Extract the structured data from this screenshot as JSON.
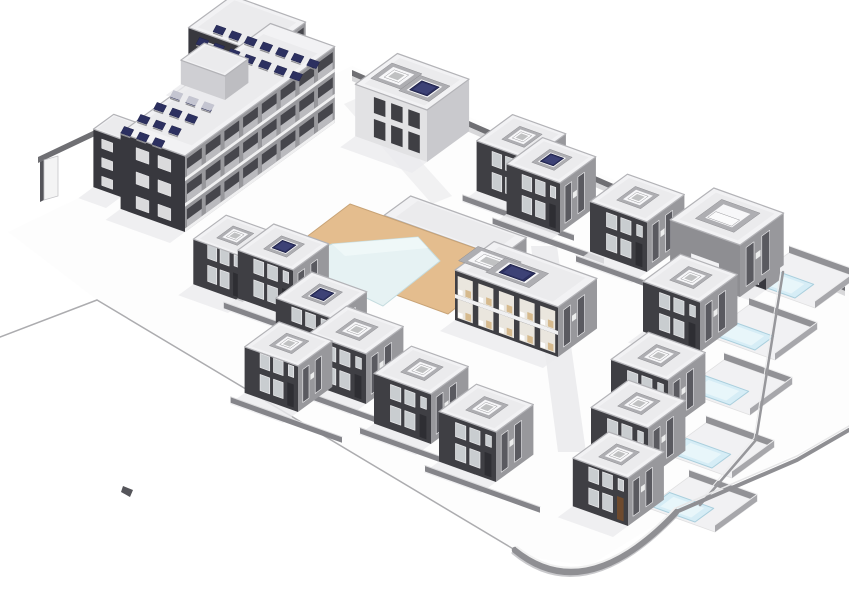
{
  "meta": {
    "alt": "Axonometric 3D architectural rendering of a residential compound: L-shaped apartment block with rooftop solar panels, two-storey villas with recessed roof terraces, central swimming pool with tan deck and pavilion, and villas with private plunge pools along a curved boundary wall.",
    "background": "#ffffff"
  },
  "palette": {
    "ground": "#fdfdfd",
    "road": "#ededef",
    "boundary": "#acacaf",
    "wallTopDark": "#6f6f73",
    "wallTopLight": "#d8d8da",
    "dark": "#3f3f44",
    "darkApt": "#38383e",
    "med": "#98989c",
    "med2": "#8e8e92",
    "light": "#c9c9cd",
    "roof": "#f2f2f4",
    "roofInner": "#ebebed",
    "parapet": "#b3b3b7",
    "curb": "#aeaeb2",
    "curbIn": "#f7f7f9",
    "solar": "#2c3060",
    "solarHi": "#4a4f86",
    "glass": "#c9cdd0",
    "frame": "#ececee",
    "medGlass": "#5a5a60",
    "deck": "#e4bd8e",
    "deckEdge": "#c8a376",
    "pool": "#e6f2f3",
    "poolEdge": "#c5dcdf",
    "courtSlab": "#f1f1f3",
    "courtWall": "#929296",
    "villaPool": "#d6edf6",
    "villaPoolEdge": "#aacfdd",
    "shadow": "#ebebed",
    "lowWall": "#85858a",
    "interior": "#eae6de",
    "furniture": "#d6ba8e",
    "slab": "#f0f0f1",
    "door": "#2e2e33",
    "doorBrown": "#6e4a2e",
    "lightWall": "#e2e2e4"
  },
  "scene": {
    "items": [
      {
        "k": "poly",
        "n": "site-ground",
        "f": "ground",
        "p": [
          [
            8,
            232
          ],
          [
            352,
            66
          ],
          [
            849,
            282
          ],
          [
            849,
            428
          ],
          [
            676,
            512
          ],
          [
            589,
            566
          ],
          [
            522,
            556
          ],
          [
            97,
            300
          ]
        ]
      },
      {
        "k": "poly",
        "n": "road-north",
        "f": "road",
        "o": 0.8,
        "p": [
          [
            344,
            104
          ],
          [
            362,
            96
          ],
          [
            452,
            196
          ],
          [
            432,
            204
          ]
        ]
      },
      {
        "k": "poly",
        "n": "road-central",
        "f": "road",
        "p": [
          [
            531,
            246
          ],
          [
            557,
            246
          ],
          [
            586,
            452
          ],
          [
            558,
            452
          ]
        ]
      },
      {
        "k": "line",
        "n": "boundary-west",
        "a": [
          0,
          337
        ],
        "b": [
          97,
          300
        ],
        "s": "boundary",
        "wd": 1.5
      },
      {
        "k": "line",
        "n": "boundary-southwest",
        "a": [
          97,
          300
        ],
        "b": [
          515,
          550
        ],
        "s": "boundary",
        "wd": 1.5
      },
      {
        "k": "poly",
        "n": "north-boundary-wall",
        "f": "wallTopDark",
        "p": [
          [
            352,
            70
          ],
          [
            845,
            285
          ],
          [
            845,
            291
          ],
          [
            352,
            76
          ]
        ]
      },
      {
        "k": "poly",
        "n": "north-boundary-wall-face",
        "f": "wallTopLight",
        "p": [
          [
            352,
            76
          ],
          [
            845,
            291
          ],
          [
            845,
            296
          ],
          [
            352,
            81
          ]
        ]
      },
      {
        "k": "poly",
        "n": "entry-wall",
        "f": "wallTopDark",
        "p": [
          [
            38,
            157
          ],
          [
            95,
            130
          ],
          [
            95,
            136
          ],
          [
            38,
            163
          ]
        ]
      },
      {
        "k": "poly",
        "n": "entry-pillar-shade",
        "f": "#55555a",
        "p": [
          [
            40,
            162
          ],
          [
            44,
            160
          ],
          [
            44,
            200
          ],
          [
            40,
            202
          ]
        ]
      },
      {
        "k": "poly",
        "n": "entry-pillar",
        "f": "#f4f4f4",
        "st": "#c5c5c8",
        "wd": 0.8,
        "p": [
          [
            44,
            160
          ],
          [
            58,
            156
          ],
          [
            58,
            196
          ],
          [
            44,
            200
          ]
        ]
      },
      {
        "k": "apt",
        "n": "apartment-north-wing",
        "c": [
          262,
          120
        ],
        "w": 80,
        "d": 56,
        "h": 66,
        "wins": {
          "rows": 3,
          "cols": 2
        },
        "balc": {
          "floors": 3,
          "cells": 3
        }
      },
      {
        "k": "apt",
        "n": "apartment-west-annex",
        "c": [
          121,
          197
        ],
        "w": 30,
        "d": 26,
        "h": 58,
        "wins": {
          "rows": 3,
          "cols": 1
        }
      },
      {
        "k": "apt",
        "n": "apartment-main-wing",
        "c": [
          185,
          232
        ],
        "w": 70,
        "d": 192,
        "h": 76,
        "wins": {
          "rows": 3,
          "cols": 2
        },
        "balc": {
          "floors": 3,
          "cells": 8
        }
      },
      {
        "k": "array",
        "n": "solar-array-north",
        "og": [
          196,
          44
        ],
        "rows": 2,
        "cols": 7,
        "cs": [
          15.6,
          5.6
        ],
        "rs": [
          17,
          -12.3
        ]
      },
      {
        "k": "array",
        "n": "solar-array-west",
        "og": [
          170,
          97
        ],
        "rows": 4,
        "cols": 3,
        "cs": [
          15.6,
          5.6
        ],
        "rs": [
          -16.4,
          12
        ]
      },
      {
        "k": "apt",
        "n": "apartment-roof-penthouse",
        "c": [
          225,
          100
        ],
        "w": 48,
        "d": 30,
        "h": 24,
        "lightStyle": 1
      },
      {
        "k": "villa",
        "n": "apartment-east-block",
        "c": [
          427,
          162
        ],
        "w": 78,
        "d": 54,
        "h": 52,
        "facade": "light",
        "openings": [
          {
            "fx": 0.72,
            "fy": 0.5,
            "item": "unit"
          },
          {
            "fx": 0.3,
            "fy": 0.45,
            "item": "panel"
          }
        ]
      },
      {
        "k": "villa",
        "n": "villa-north-1",
        "c": [
          530,
          210
        ],
        "w": 58,
        "d": 46,
        "h": 50,
        "item": "unit",
        "fw": 1
      },
      {
        "k": "villa",
        "n": "villa-north-2",
        "c": [
          560,
          233
        ],
        "w": 58,
        "d": 46,
        "h": 50,
        "item": "panel",
        "fw": 1
      },
      {
        "k": "villa",
        "n": "villa-north-3",
        "c": [
          647,
          272
        ],
        "w": 62,
        "d": 48,
        "h": 50,
        "item": "unit",
        "fw": 1
      },
      {
        "k": "court",
        "n": "pool-court-corner",
        "slab": [
          815,
          308
        ],
        "sw": 74,
        "sd": 54,
        "water": [
          795,
          298
        ],
        "pw": 48,
        "pd": 24
      },
      {
        "k": "apt",
        "n": "villa-corner-annex",
        "c": [
          766,
          290
        ],
        "w": 26,
        "d": 18,
        "h": 34,
        "wins": {
          "rows": 1,
          "cols": 1
        }
      },
      {
        "k": "villa",
        "n": "villa-corner",
        "c": [
          740,
          297
        ],
        "w": 76,
        "d": 56,
        "h": 52,
        "item": "unitlong",
        "medStyle": 1
      },
      {
        "k": "pav",
        "n": "pool-pavilion",
        "c": [
          500,
          287
        ],
        "w": 126,
        "d": 34,
        "h": 30
      },
      {
        "k": "poly",
        "n": "pool-deck",
        "f": "deck",
        "st": "deckEdge",
        "wd": 1,
        "p": [
          [
            448,
            314
          ],
          [
            284,
            254
          ],
          [
            350,
            204
          ],
          [
            514,
            262
          ]
        ]
      },
      {
        "k": "poly",
        "n": "main-pool",
        "f": "pool",
        "st": "poolEdge",
        "wd": 1,
        "p": [
          [
            299,
            259
          ],
          [
            332,
            244
          ],
          [
            418,
            237
          ],
          [
            440,
            261
          ],
          [
            383,
            306
          ],
          [
            350,
            290
          ],
          [
            322,
            282
          ]
        ]
      },
      {
        "k": "poly",
        "n": "main-pool-shallow-step",
        "f": "#f2fafa",
        "o": 0.75,
        "p": [
          [
            332,
            244
          ],
          [
            418,
            237
          ],
          [
            428,
            248
          ],
          [
            345,
            256
          ]
        ]
      },
      {
        "k": "villa",
        "n": "villa-center-0",
        "c": [
          243,
          302
        ],
        "w": 54,
        "d": 42,
        "h": 45,
        "item": "unit"
      },
      {
        "k": "villa",
        "n": "villa-center-1",
        "c": [
          293,
          318
        ],
        "w": 60,
        "d": 46,
        "h": 48,
        "item": "panel",
        "fw": 1
      },
      {
        "k": "duplex",
        "n": "duplex-open-interior",
        "c": [
          558,
          357
        ],
        "w": 112,
        "d": 50,
        "h": 50,
        "openings": [
          {
            "fx": 0.85,
            "fy": 0.5,
            "item": "unit"
          },
          {
            "fx": 0.57,
            "fy": 0.46,
            "item": "panel"
          }
        ]
      },
      {
        "k": "court",
        "n": "pool-court-1",
        "slab": [
          775,
          360
        ],
        "sw": 74,
        "sd": 54,
        "water": [
          755,
          350
        ],
        "pw": 48,
        "pd": 24
      },
      {
        "k": "villa",
        "n": "villa-east-1",
        "c": [
          700,
          352
        ],
        "w": 62,
        "d": 48,
        "h": 50,
        "item": "unit"
      },
      {
        "k": "villa",
        "n": "villa-center-2",
        "c": [
          331,
          366
        ],
        "w": 60,
        "d": 46,
        "h": 48,
        "item": "panel",
        "fw": 1
      },
      {
        "k": "villa",
        "n": "villa-south-1",
        "c": [
          366,
          404
        ],
        "w": 62,
        "d": 48,
        "h": 50,
        "item": "unit",
        "fw": 1
      },
      {
        "k": "villa",
        "n": "villa-center-3",
        "c": [
          298,
          412
        ],
        "w": 58,
        "d": 44,
        "h": 46,
        "item": "unit",
        "fw": 1
      },
      {
        "k": "court",
        "n": "pool-court-2",
        "slab": [
          750,
          415
        ],
        "sw": 74,
        "sd": 54,
        "water": [
          730,
          405
        ],
        "pw": 48,
        "pd": 24
      },
      {
        "k": "villa",
        "n": "villa-east-2",
        "c": [
          668,
          430
        ],
        "w": 62,
        "d": 48,
        "h": 50,
        "item": "unit"
      },
      {
        "k": "villa",
        "n": "villa-south-2",
        "c": [
          431,
          444
        ],
        "w": 62,
        "d": 48,
        "h": 50,
        "item": "unit",
        "fw": 1
      },
      {
        "k": "court",
        "n": "pool-court-3",
        "slab": [
          732,
          478
        ],
        "sw": 74,
        "sd": 54,
        "water": [
          712,
          468
        ],
        "pw": 48,
        "pd": 24
      },
      {
        "k": "villa",
        "n": "villa-east-3",
        "c": [
          648,
          478
        ],
        "w": 62,
        "d": 48,
        "h": 50,
        "item": "unit"
      },
      {
        "k": "villa",
        "n": "villa-south-3",
        "c": [
          496,
          482
        ],
        "w": 62,
        "d": 48,
        "h": 50,
        "item": "unit",
        "fw": 1
      },
      {
        "k": "court",
        "n": "pool-court-4",
        "slab": [
          715,
          532
        ],
        "sw": 74,
        "sd": 54,
        "water": [
          695,
          522
        ],
        "pw": 48,
        "pd": 24
      },
      {
        "k": "villa",
        "n": "villa-east-4",
        "c": [
          628,
          526
        ],
        "w": 60,
        "d": 46,
        "h": 48,
        "item": "unit",
        "brownDoor": 1
      },
      {
        "k": "path",
        "n": "courts-east-wall",
        "d": "M 783,272 L 756,440 L 700,505",
        "s": "#97979b",
        "wd": 2.5
      },
      {
        "k": "path",
        "n": "courts-east-wall-cap",
        "d": "M 781,270 L 754,438 L 698,503",
        "s": "#ededee",
        "wd": 1
      },
      {
        "k": "path",
        "n": "boundary-southeast",
        "d": "M 676,512 L 797,460 L 849,430",
        "s": "#8f8f93",
        "wd": 4
      },
      {
        "k": "path",
        "n": "boundary-southeast-cap",
        "d": "M 676,508 L 797,456 L 849,426",
        "s": "#e6e6e7",
        "wd": 1.5
      },
      {
        "k": "path",
        "n": "curved-wall-base",
        "d": "M 676,516 Q 584,612 513,553",
        "s": "#c9c9cc",
        "wd": 3
      },
      {
        "k": "path",
        "n": "curved-corner-wall",
        "d": "M 676,512 Q 585,608 515,550",
        "s": "#8f8f93",
        "wd": 6.5
      },
      {
        "k": "path",
        "n": "curved-corner-wall-cap",
        "d": "M 675,508 Q 586,603 517,547",
        "s": "#f0f0f0",
        "wd": 2
      },
      {
        "k": "poly",
        "n": "site-marker",
        "f": "#55555a",
        "p": [
          [
            123,
            486
          ],
          [
            133,
            490
          ],
          [
            130,
            497
          ],
          [
            121,
            492
          ]
        ]
      }
    ]
  }
}
